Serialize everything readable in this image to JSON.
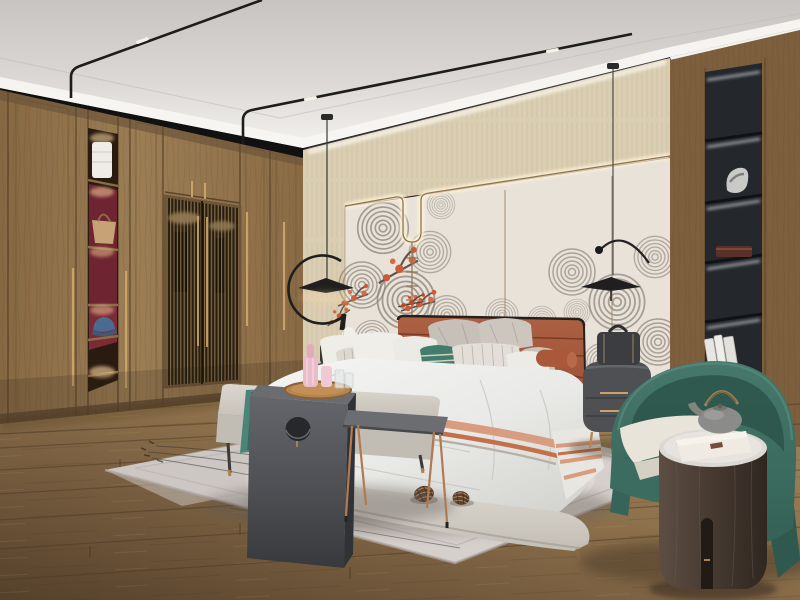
{
  "scene": {
    "title": "Modern Chinese-style bedroom interior render",
    "setting": "luxury bedroom, daytime ambient with warm accent lighting",
    "objects": {
      "ceiling": {
        "label": "white recessed tray ceiling"
      },
      "track_lights": {
        "label": "black magnetic track light rails with LED spot clusters"
      },
      "wardrobe": {
        "label": "full-height walnut wardrobe wall with display niches and lattice doors"
      },
      "display_niches": {
        "label": "red-backed lighted niches with towel, handbag and blue cap"
      },
      "lattice_doors": {
        "label": "Chinese lattice wardrobe doors with brass pulls"
      },
      "accent_wall": {
        "label": "beige textured band over cream headboard panels"
      },
      "trim": {
        "label": "brass trim line with LED backlight and U-shaped drop"
      },
      "wall_art": {
        "label": "gray swirl mountain mural with red plum blossoms"
      },
      "pendant_left": {
        "label": "black arc pendant lamp over left nightstand"
      },
      "pendant_right": {
        "label": "black arc pendant lamp over right nightstand"
      },
      "bed": {
        "label": "upholstered bed with terracotta leather channel headboard"
      },
      "pillows": {
        "label": "gray, white, striped and teal accent pillows with terracotta bolster"
      },
      "throw_blanket": {
        "label": "white runner with salmon and terracotta stripes"
      },
      "bench": {
        "label": "light gray foot-of-bed bench with teal throw"
      },
      "c_table": {
        "label": "dark gray waterfall table with circular cutout"
      },
      "metal_table": {
        "label": "gray tray table with copper legs"
      },
      "serving_tray": {
        "label": "round wood tray with pink decanters and glasses"
      },
      "nightstand_left": {
        "label": "dark drum nightstand with white gourd table lamp"
      },
      "nightstand_right": {
        "label": "dark gray rounded nightstand with brass legs and travel case"
      },
      "shelf_unit": {
        "label": "black built-in display column with lit shelves, sculpture, box and books"
      },
      "armchair": {
        "label": "teal barrel armchair with cream seat cushion"
      },
      "side_table": {
        "label": "cylindrical walnut side table with marble top"
      },
      "teapot": {
        "label": "gray teapot with bamboo handle on white box"
      },
      "rug": {
        "label": "pale gray area rug with thin branch lines"
      },
      "pine_cones": {
        "label": "two pine cones on the rug"
      },
      "floor": {
        "label": "warm brown wood plank floor"
      }
    },
    "counts": {
      "pendant_lamps": 2,
      "pine_cones": 2,
      "wardrobe_niches": 5,
      "shelf_niches": 5
    }
  },
  "palette": {
    "ceiling_gray": "#d2cfcc",
    "ceiling_white": "#f4f2ef",
    "wardrobe_wood": "#93754e",
    "niche_red": "#6f2531",
    "wall_beige": "#d9cdb2",
    "wall_cream": "#e9e2d8",
    "brass": "#a5875f",
    "art_gray": "#7a7268",
    "blossom_red": "#c8431e",
    "headboard_leather": "#a2563a",
    "pillow_teal": "#417c6c",
    "duvet_white": "#eff0ee",
    "blanket_salmon": "#d89d80",
    "blanket_terracotta": "#c2714b",
    "bench_gray": "#cdc8c0",
    "dark_table": "#54565a",
    "rug_gray": "#d6d0cc",
    "floor_brown": "#8b6f4b",
    "armchair_teal": "#3e6e62",
    "cushion_cream": "#e9e4d9",
    "shelf_black": "#24272b",
    "throw_teal": "#4b8577",
    "glow_warm": "#ffdfa6"
  }
}
